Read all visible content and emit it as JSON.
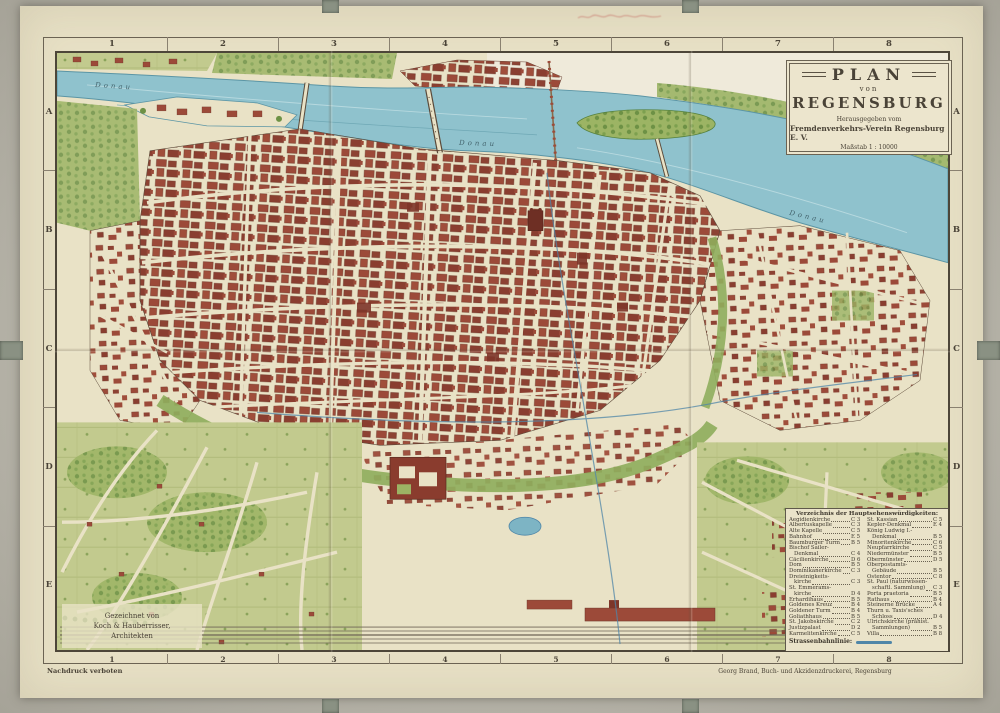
{
  "map": {
    "title_block": {
      "title": "PLAN",
      "von": "von",
      "city": "REGENSBURG",
      "publisher_line1": "Herausgegeben vom",
      "publisher_line2": "Fremdenverkehrs-Verein Regensburg E. V.",
      "scale": "Maßstab 1 : 10000"
    },
    "grid": {
      "columns": [
        "1",
        "2",
        "3",
        "4",
        "5",
        "6",
        "7",
        "8"
      ],
      "rows": [
        "A",
        "B",
        "C",
        "D",
        "E"
      ]
    },
    "river_label": "Donau",
    "legend": {
      "heading": "Verzeichnis der Hauptsehenswürdigkeiten:",
      "tram_label": "Strassenbahnlinie:",
      "col1": [
        {
          "text": "Aegidienkirche",
          "ref": "C 3"
        },
        {
          "text": "Albertuskapelle",
          "ref": "C 3"
        },
        {
          "text": "Alte Kapelle",
          "ref": "C 5"
        },
        {
          "text": "Bahnhof",
          "ref": "E 5"
        },
        {
          "text": "Baumburger Turm",
          "ref": "B 5"
        },
        {
          "text": "Bischof Sailer-",
          "ref": "",
          "cls": "noref"
        },
        {
          "text": "Denkmal",
          "ref": "C 4",
          "cls": "indent"
        },
        {
          "text": "Cäcilienkirche",
          "ref": "D 6"
        },
        {
          "text": "Dom",
          "ref": "B 5"
        },
        {
          "text": "Dominikanerkirche",
          "ref": "C 3"
        },
        {
          "text": "Dreieinigkeits-",
          "ref": "",
          "cls": "noref"
        },
        {
          "text": "kirche",
          "ref": "C 3",
          "cls": "indent"
        },
        {
          "text": "St. Emmerams-",
          "ref": "",
          "cls": "noref"
        },
        {
          "text": "kirche",
          "ref": "D 4",
          "cls": "indent"
        },
        {
          "text": "Erhardihaus",
          "ref": "B 5"
        },
        {
          "text": "Goldenes Kreuz",
          "ref": "B 4"
        },
        {
          "text": "Goldener Turm",
          "ref": "B 4"
        },
        {
          "text": "Goliathhaus",
          "ref": "B 5"
        },
        {
          "text": "St. Jakobskirche",
          "ref": "C 2"
        },
        {
          "text": "Justizpalast",
          "ref": "D 2"
        },
        {
          "text": "Karmelitenkirche",
          "ref": "C 5"
        }
      ],
      "col2": [
        {
          "text": "St. Kassian",
          "ref": "C 5"
        },
        {
          "text": "Kepler-Denkmal",
          "ref": "E 4"
        },
        {
          "text": "König Ludwig I.-",
          "ref": "",
          "cls": "noref"
        },
        {
          "text": "Denkmal",
          "ref": "B 5",
          "cls": "indent"
        },
        {
          "text": "Minoritenkirche",
          "ref": "C 6"
        },
        {
          "text": "Neupfarrkirche",
          "ref": "C 5"
        },
        {
          "text": "Niedermünster",
          "ref": "B 5"
        },
        {
          "text": "Obermünster",
          "ref": "D 5"
        },
        {
          "text": "Oberpostamts-",
          "ref": "",
          "cls": "noref"
        },
        {
          "text": "Gebäude",
          "ref": "B 5",
          "cls": "indent"
        },
        {
          "text": "Ostentor",
          "ref": "C 8"
        },
        {
          "text": "St. Paul (naturwissen-",
          "ref": "",
          "cls": "noref"
        },
        {
          "text": "schaftl. Sammlung)",
          "ref": "C 3",
          "cls": "indent"
        },
        {
          "text": "Porta praetoria",
          "ref": "B 5"
        },
        {
          "text": "Rathaus",
          "ref": "B 4"
        },
        {
          "text": "Steinerne Brücke",
          "ref": "A 4"
        },
        {
          "text": "Thurn u. Taxis'sches",
          "ref": "",
          "cls": "noref"
        },
        {
          "text": "Schloss",
          "ref": "D 4",
          "cls": "indent"
        },
        {
          "text": "Ulrichskirche (prähist.",
          "ref": "",
          "cls": "noref"
        },
        {
          "text": "Sammlungen)",
          "ref": "B 5",
          "cls": "indent"
        },
        {
          "text": "Villa",
          "ref": "B 8"
        }
      ]
    },
    "credit": {
      "line1": "Gezeichnet von",
      "line2": "Koch & Hauberrisser,",
      "line3": "Architekten"
    },
    "imprint_left": "Nachdruck verboten",
    "imprint_right": "Georg Brand, Buch- und Akzidenzdruckerei, Regensburg",
    "colors": {
      "paper": "#e7e0c5",
      "water": "#8fc2cd",
      "building_red": "#9c4a39",
      "park_green": "#9cb464",
      "tram_blue": "#4f86a8"
    }
  }
}
